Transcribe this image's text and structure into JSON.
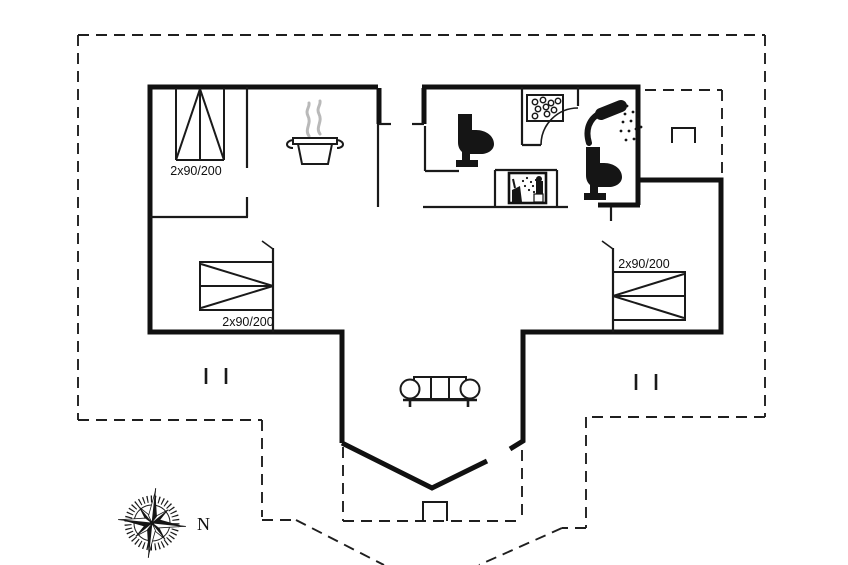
{
  "floor_plan": {
    "type": "holiday-home floor plan drawing",
    "bed_size_labels": {
      "bunk_bed": "2x90/200",
      "left_bedroom_bed": "2x90/200",
      "right_bedroom_bed": "2x90/200"
    },
    "compass_north_label": "N",
    "colors": {
      "background": "#ffffff",
      "walls": "#111111",
      "ink": "#1a1a1a",
      "steam_gray": "#b9b9b9"
    },
    "icons": [
      "bunk-bed-icon",
      "double-bed-left-icon",
      "double-bed-right-icon",
      "stove-pot-icon",
      "toilet-left-icon",
      "toilet-right-icon",
      "shower-icon",
      "whirlpool-icon",
      "sauna-icon",
      "sofa-icon",
      "step-marker-top-icon",
      "step-marker-bottom-icon",
      "wall-tick-pair-left",
      "wall-tick-pair-right",
      "compass-rose-icon"
    ]
  }
}
